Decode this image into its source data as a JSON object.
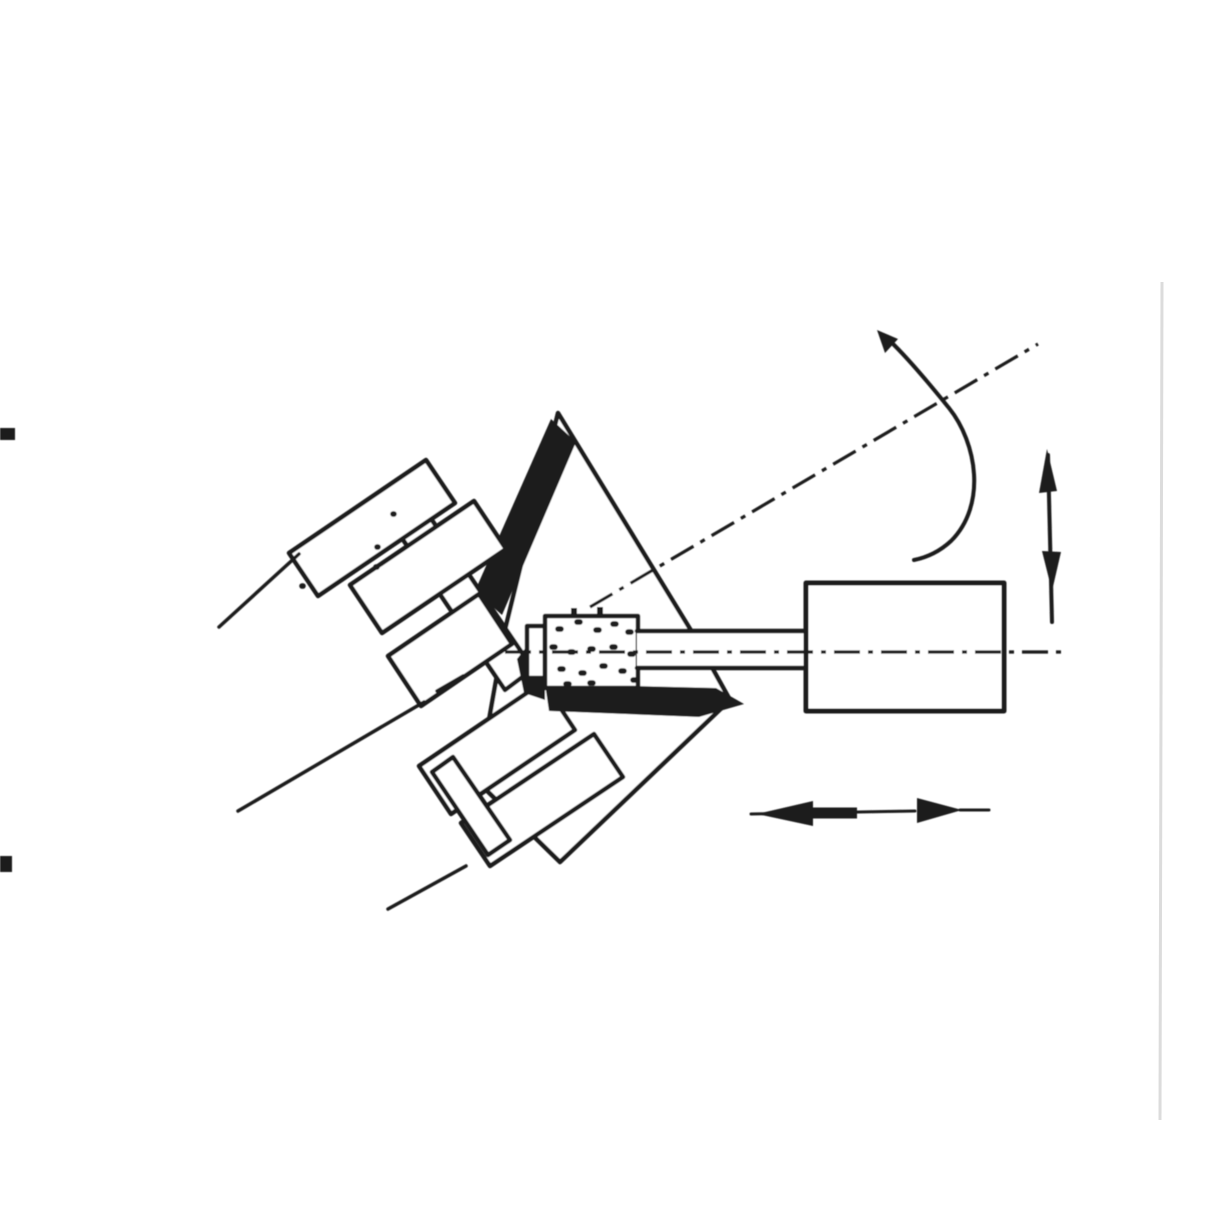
{
  "document": {
    "kind": "scanned-technical-illustration",
    "description": "Hand-drawn cutaway figure of an internal grinding setup: a flanged workpiece assembly tilted on its rotating axis, a small stippled grinding wheel on a quill driven by a cylindrical wheelhead, with a curved rotation arrow around the work axis, a vertical infeed double arrow and a horizontal traverse double arrow.",
    "visible_text": []
  },
  "colors": {
    "ink": "#1d1d1d",
    "paper": "#ffffff",
    "edge_rule": "#dcdcdc"
  },
  "parts": [
    {
      "name": "workpiece-axis-centerline",
      "style": "dash-dot"
    },
    {
      "name": "wheel-spindle-centerline",
      "style": "dash-dot"
    },
    {
      "name": "workpiece-plate",
      "style": "outlined, sectioned with solid black bore walls"
    },
    {
      "name": "spindle-flange-assembly",
      "style": "stepped outlined blocks"
    },
    {
      "name": "grinding-wheel",
      "style": "stippled rectangle"
    },
    {
      "name": "wheel-quill",
      "style": "parallel lines"
    },
    {
      "name": "wheelhead-cylinder",
      "style": "outlined rectangle"
    },
    {
      "name": "rotation-arrow",
      "style": "curved arc with arrowhead"
    },
    {
      "name": "infeed-arrow",
      "style": "vertical opposed arrowheads"
    },
    {
      "name": "traverse-arrow",
      "style": "horizontal opposed arrowheads"
    },
    {
      "name": "page-registration-dashes",
      "style": "two black dashes at left edge"
    },
    {
      "name": "page-edge-rule",
      "style": "faint vertical line at right edge"
    }
  ],
  "art": {
    "shaft_line_upper": "M219,627 L299,554",
    "shaft_line_middle": "M238,811 L424,702",
    "shaft_line_lower": "M388,909 L466,866",
    "plate_diamond": "M558,413 L695,637 L730,700 L560,862 L478,782 L505,630 Z",
    "bore_wall_upper": "M551,419 L576,442 L502,615 L475,591 Z",
    "axis_workpiece": "M590,607 L1038,344",
    "axis_workpiece_left_dash": "M437,691 L463,676",
    "rim_band": "M391,522 L419,501 L533,669 L505,690 Z",
    "flange_top": "M289,553 L426,460 L455,503 L318,596 Z",
    "hub_top": "M350,585 L474,501 L506,549 L382,633 Z",
    "neck": "M388,656 L479,594 L512,644 L421,706 Z",
    "hub_bottom": "M419,766 L543,682 L575,730 L451,814 Z",
    "flange_bottom": "M461,823 L594,734 L623,777 L490,866 Z",
    "end_cap": "M432,772 L453,757 L510,840 L488,855 Z",
    "flange_specks": "M393,514 h1 M377,547 h1 M376,567 h1 M302,586 h1",
    "bore_wall_lower": "M545,684 L716,688 L744,704 L699,717 L549,711 Z",
    "bore_wall_left": "M517,659 L545,623 L545,700 L524,693 Z",
    "wheel_cap": "M527,626 h18 v52 h-18 Z",
    "wheel_body": "M545,616 h93 v72 h-93 Z",
    "wheel_stipple": "M558,629 h3 M577,622 h3 M596,630 h3 M613,624 h3 M628,632 h3 M552,647 h3 M570,652 h3 M590,649 h3 M612,647 h3 M630,654 h3 M560,669 h3 M581,673 h3 M602,666 h3 M621,671 h3 M633,680 h3 M566,684 h3 M590,683 h3",
    "wheel_top_ticks": "M574,608 v8 M600,607 v8",
    "quill_fill": "M637,632 h170 v36 h-170 Z",
    "quill_lines": "M637,631 H808 M637,668 H808",
    "wheelhead_body": "M806,583 h198 v128 h-198 Z",
    "axis_wheel": "M505,652 H1062",
    "rotation_arc": "M890,341 C912,362 936,392 949,408 C977,443 987,505 951,541 C938,553 924,558 914,560",
    "rotation_arrowhead": "M877,330 L898,339 L885,353 Z",
    "infeed_stem": "M1048,455 L1052,622",
    "infeed_head_up": "M1047,449 L1039,493 L1057,491 Z",
    "infeed_head_down": "M1052,591 L1042,551 L1061,552 Z",
    "traverse_stem": "M751,814 L915,811",
    "traverse_head_left": "M757,814 L813,801 L813,826 Z",
    "traverse_mid_bar": "M813,813 L857,813",
    "traverse_head_right": "M962,810 L917,798 L917,823 Z",
    "traverse_tip_right": "M960,810 L989,810",
    "edge_dash_top": "M0,428 h15 v12 h-15 Z",
    "edge_dash_bottom": "M0,856 h12 v16 h-12 Z",
    "edge_rule_right": "M1162,282 L1160,1120"
  }
}
